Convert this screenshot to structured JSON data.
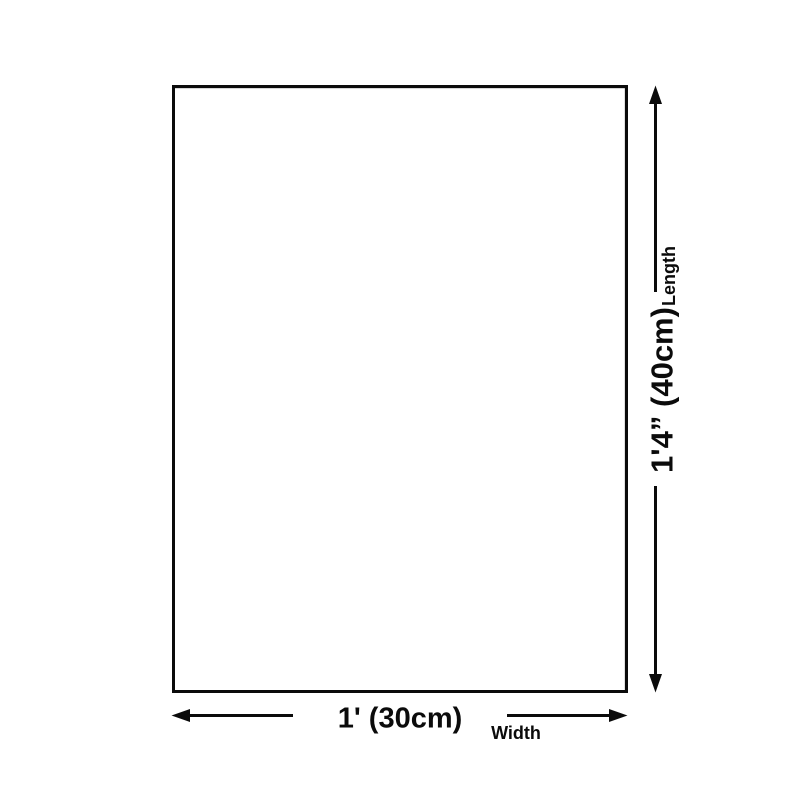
{
  "dimensions": {
    "length": {
      "value": "1'4” (40cm)",
      "label": "Length"
    },
    "width": {
      "value": "1' (30cm)",
      "label": "Width"
    }
  },
  "colors": {
    "line": "#0b0b0b",
    "background": "#ffffff",
    "product_fill": "#ffffff"
  }
}
